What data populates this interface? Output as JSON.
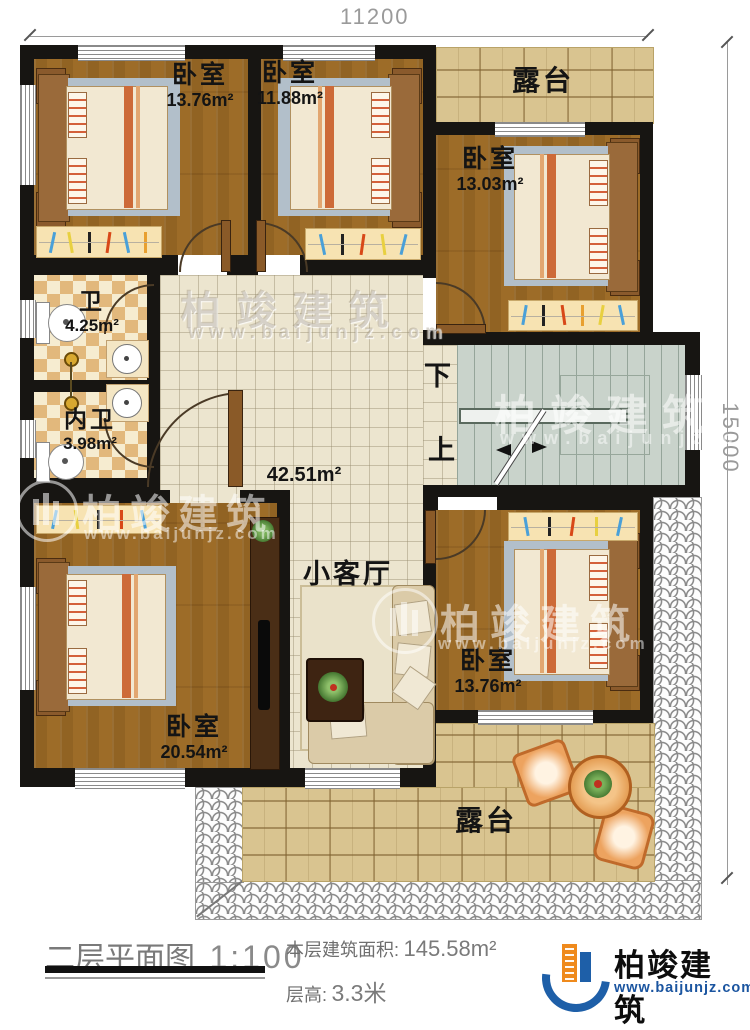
{
  "dimensions": {
    "top": "11200",
    "right": "15000"
  },
  "rooms": {
    "bedroom_top_left": {
      "name": "卧室",
      "area": "13.76m²"
    },
    "bedroom_top_mid": {
      "name": "卧室",
      "area": "11.88m²"
    },
    "terrace_top": {
      "name": "露台"
    },
    "bedroom_right": {
      "name": "卧室",
      "area": "13.03m²"
    },
    "bathroom": {
      "name": "卫",
      "area": "4.25m²"
    },
    "ensuite_bathroom": {
      "name": "内卫",
      "area": "3.98m²"
    },
    "hall": {
      "area": "42.51m²"
    },
    "living": {
      "name": "小客厅"
    },
    "stairs": {
      "down": "下",
      "up": "上"
    },
    "bedroom_bottom_left": {
      "name": "卧室",
      "area": "20.54m²"
    },
    "bedroom_bottom_right": {
      "name": "卧室",
      "area": "13.76m²"
    },
    "terrace_bottom": {
      "name": "露台"
    }
  },
  "watermark": {
    "brand": "柏竣建筑",
    "site": "www.baijunjz.com"
  },
  "footer": {
    "plan_title": "二层平面图",
    "plan_scale": "1:100",
    "area_label": "本层建筑面积:",
    "area_value": "145.58m²",
    "floor_height_label": "层高:",
    "floor_height_value": "3.3米"
  },
  "logo": {
    "brand": "柏竣建筑",
    "site": "www.baijunjz.com"
  },
  "colors": {
    "accent_blue": "#1e5fa8",
    "accent_orange": "#ef8a1c",
    "wall": "#171512"
  }
}
